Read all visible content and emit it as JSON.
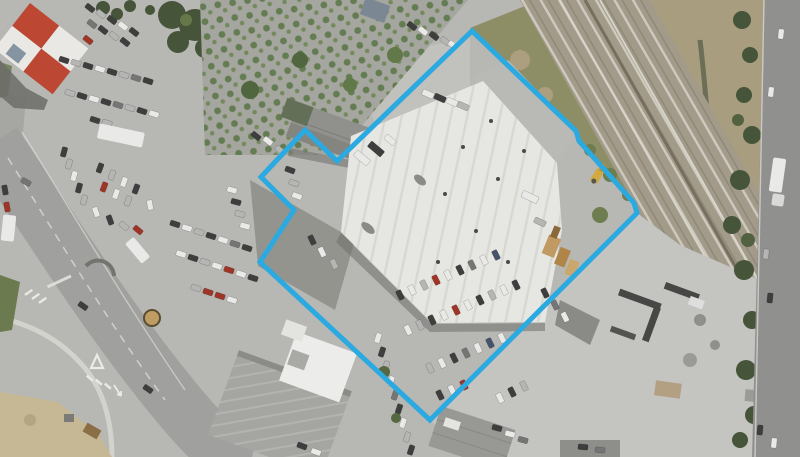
{
  "map": {
    "view": "aerial-photograph-with-property-boundary-overlay",
    "boundary_overlay": {
      "color": "#2BA9E1",
      "stroke_width": 5,
      "points": "472,31 576,131 579,141 634,203 637,213 430,420 260,262 294,210 261,177 305,130 337,161"
    },
    "palette": {
      "pavement": "#b7b7b3",
      "pavement_dark": "#90908e",
      "concrete_light": "#c4c4c0",
      "warehouse_roof": "#e6e6e2",
      "red_roof": "#bc4733",
      "roof_white_panel": "#eae8e4",
      "white_roof": "#ececea",
      "gray_roof": "#a5a5a1",
      "shed_roof": "#90908c",
      "rail_ballast": "#a39b8a",
      "grass": "#8d8e66",
      "field": "#a89d7f",
      "trees": "#46543a",
      "road": "#a0a09e",
      "road_east": "#90908e",
      "dirt": "#c6b795",
      "nursery_ground": "#a6a6a0"
    }
  }
}
